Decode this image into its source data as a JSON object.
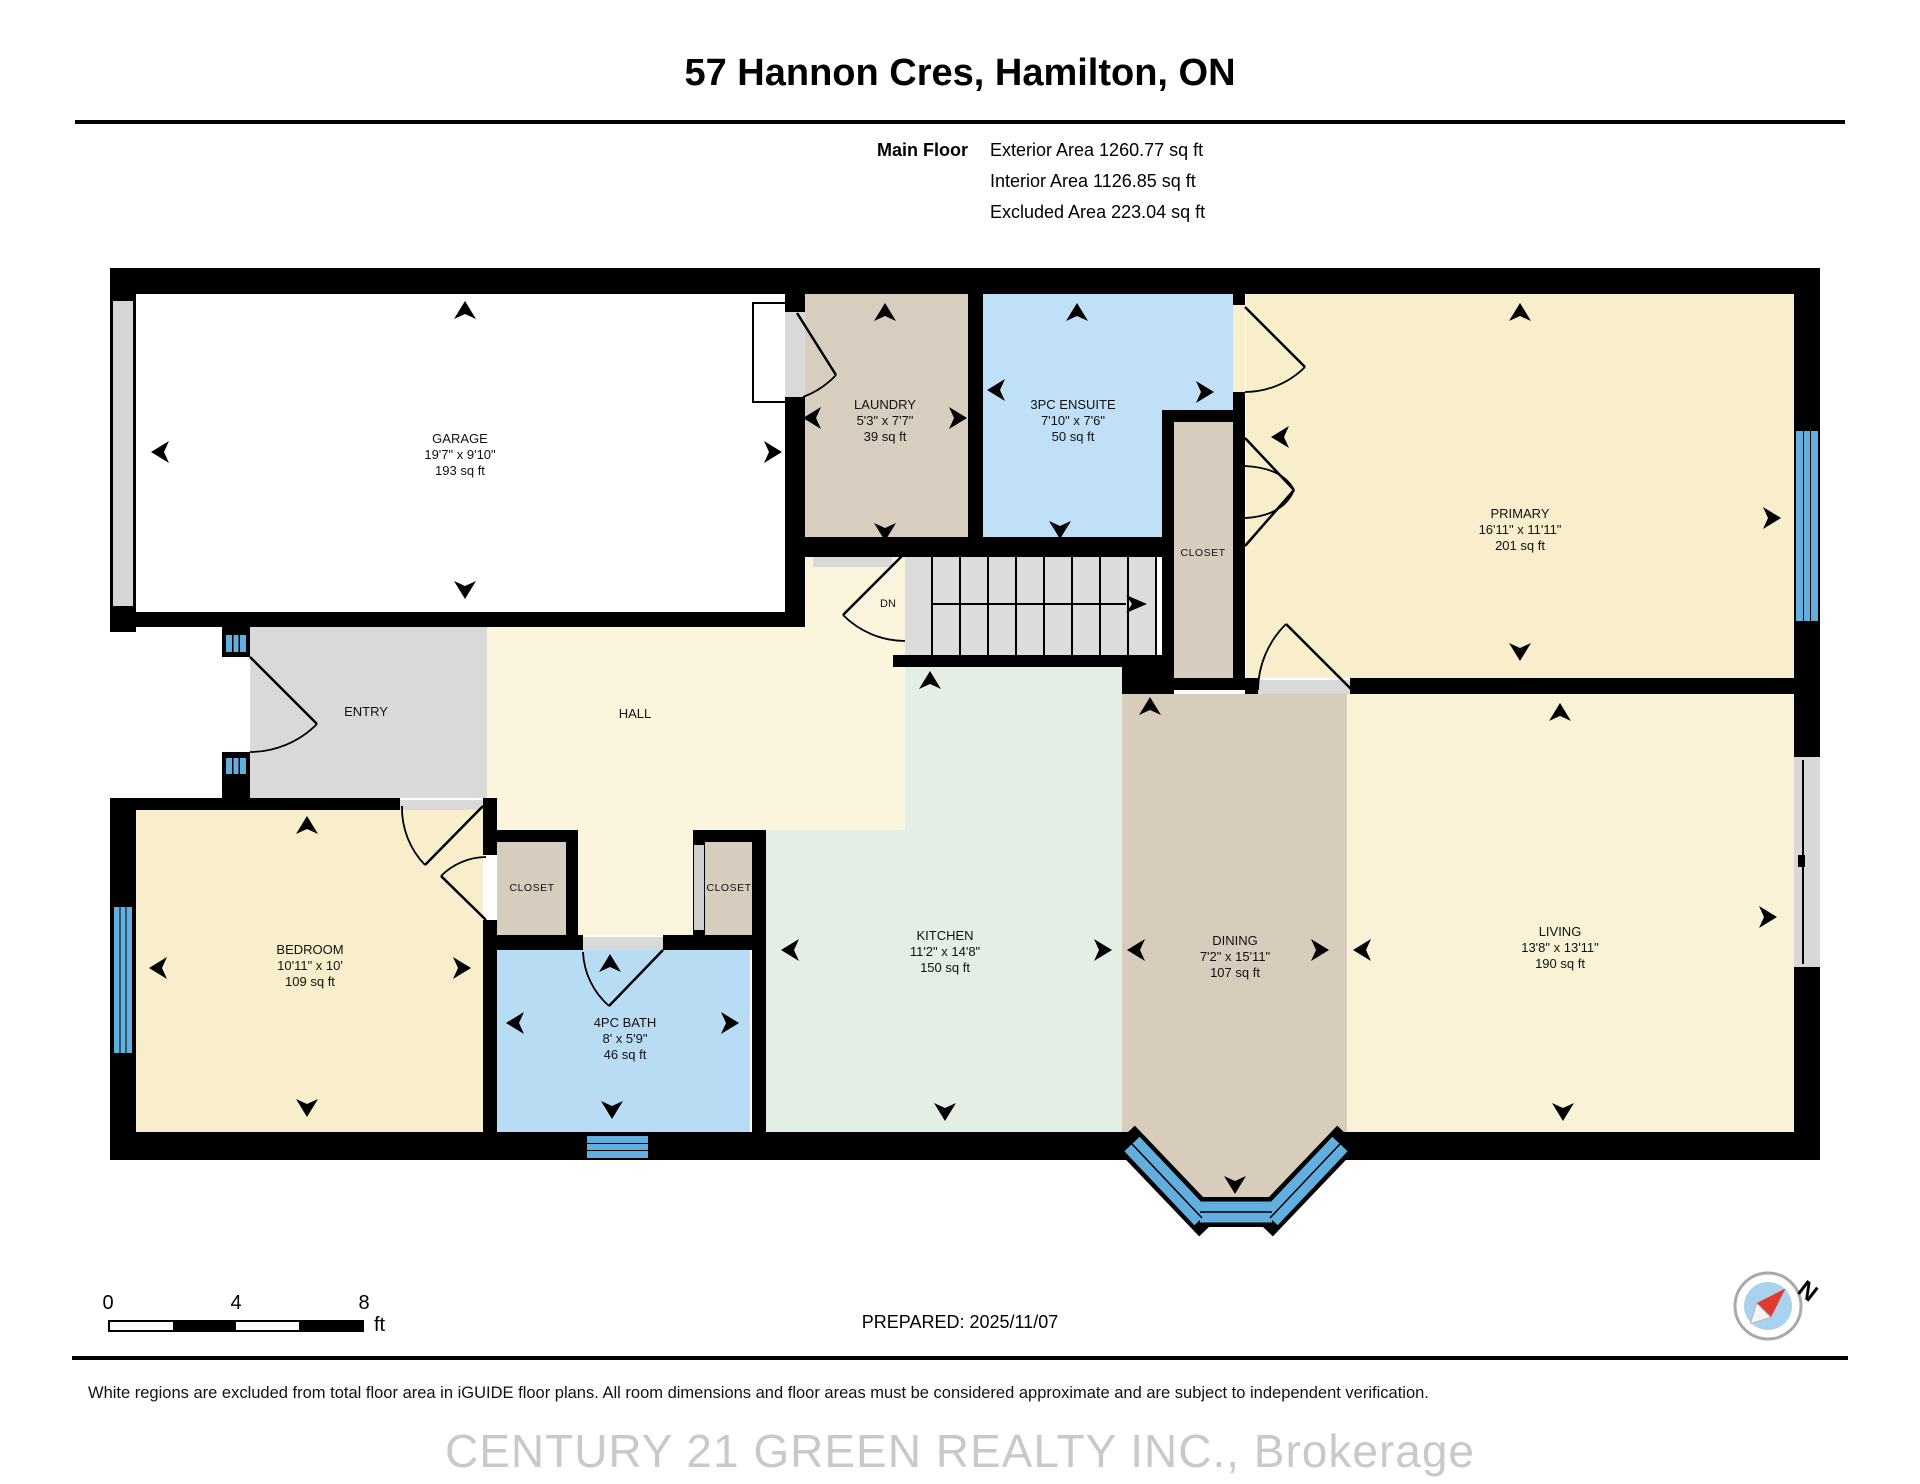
{
  "header": {
    "title": "57 Hannon Cres, Hamilton, ON",
    "floor_label": "Main Floor",
    "stats": [
      "Exterior Area 1260.77 sq ft",
      "Interior Area 1126.85 sq ft",
      "Excluded Area 223.04 sq ft"
    ]
  },
  "rooms": {
    "garage": {
      "name": "GARAGE",
      "dims": "19'7\" x 9'10\"",
      "area": "193 sq ft"
    },
    "laundry": {
      "name": "LAUNDRY",
      "dims": "5'3\" x 7'7\"",
      "area": "39 sq ft"
    },
    "ensuite": {
      "name": "3PC ENSUITE",
      "dims": "7'10\" x 7'6\"",
      "area": "50 sq ft"
    },
    "primary": {
      "name": "PRIMARY",
      "dims": "16'11\" x 11'11\"",
      "area": "201 sq ft"
    },
    "primary_closet": {
      "name": "CLOSET"
    },
    "entry": {
      "name": "ENTRY"
    },
    "hall": {
      "name": "HALL"
    },
    "stairs": {
      "name": "DN"
    },
    "closet_left": {
      "name": "CLOSET"
    },
    "closet_right": {
      "name": "CLOSET"
    },
    "bedroom": {
      "name": "BEDROOM",
      "dims": "10'11\" x 10'",
      "area": "109 sq ft"
    },
    "bath": {
      "name": "4PC BATH",
      "dims": "8' x 5'9\"",
      "area": "46 sq ft"
    },
    "kitchen": {
      "name": "KITCHEN",
      "dims": "11'2\" x 14'8\"",
      "area": "150 sq ft"
    },
    "dining": {
      "name": "DINING",
      "dims": "7'2\" x 15'11\"",
      "area": "107 sq ft"
    },
    "living": {
      "name": "LIVING",
      "dims": "13'8\" x 13'11\"",
      "area": "190 sq ft"
    }
  },
  "footer": {
    "scale_ticks": [
      "0",
      "4",
      "8"
    ],
    "scale_unit": "ft",
    "prepared": "PREPARED: 2025/11/07",
    "disclaimer": "White regions are excluded from total floor area in iGUIDE floor plans. All room dimensions and floor areas must be considered approximate and are subject to independent verification.",
    "watermark": "CENTURY 21 GREEN REALTY INC., Brokerage",
    "compass_label": "N"
  },
  "colors": {
    "wall": "#000000",
    "window_blue": "#62aede",
    "cream": "#f8eecb",
    "cream_light": "#fcf5dd",
    "tan": "#d8cec0",
    "blue_room": "#bfe0f7",
    "green_room": "#e3eee4",
    "gray_room": "#d9d9d9",
    "garage_white": "#ffffff",
    "compass_red": "#e03a2f"
  }
}
